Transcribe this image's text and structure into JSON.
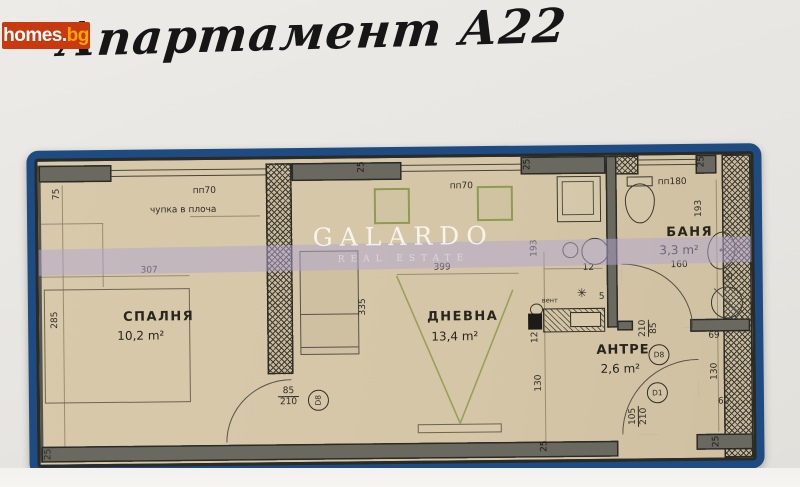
{
  "site": {
    "logo_primary": "homes.",
    "logo_suffix": "bg"
  },
  "title": "Апартамент А22",
  "watermark": {
    "name": "GALARDO",
    "tagline": "REAL ESTATE"
  },
  "rooms": {
    "bedroom": {
      "name": "СПАЛНЯ",
      "area": "10,2 m²"
    },
    "living": {
      "name": "ДНЕВНА",
      "area": "13,4 m²"
    },
    "bath": {
      "name": "БАНЯ",
      "area": "3,3 m²"
    },
    "hall": {
      "name": "АНТРЕ",
      "area": "2,6 m²"
    }
  },
  "notes": {
    "slab": "чупка в плоча",
    "pp70": "пп70",
    "pp180": "пп180",
    "vent": "вент",
    "vent_star": "✳",
    "p": "п"
  },
  "doors": {
    "d8": {
      "id": "D8",
      "w": "85",
      "h": "210"
    },
    "d1": {
      "id": "D1",
      "w": "105",
      "h": "210"
    }
  },
  "dims": {
    "d75": "75",
    "d285": "285",
    "d307": "307",
    "d25": "25",
    "d335": "335",
    "d399": "399",
    "d193": "193",
    "d12": "12",
    "d5": "5",
    "d130": "130",
    "d160": "160",
    "d69": "69",
    "d60": "60"
  },
  "colors": {
    "frame_blue": "#1e4c82",
    "paper_tan": "#d6c7a8",
    "logo_bg": "#c8390f",
    "logo_accent": "#f7a600",
    "stripe_lavender": "#b0a5d2",
    "window_green": "#8f9b53"
  }
}
